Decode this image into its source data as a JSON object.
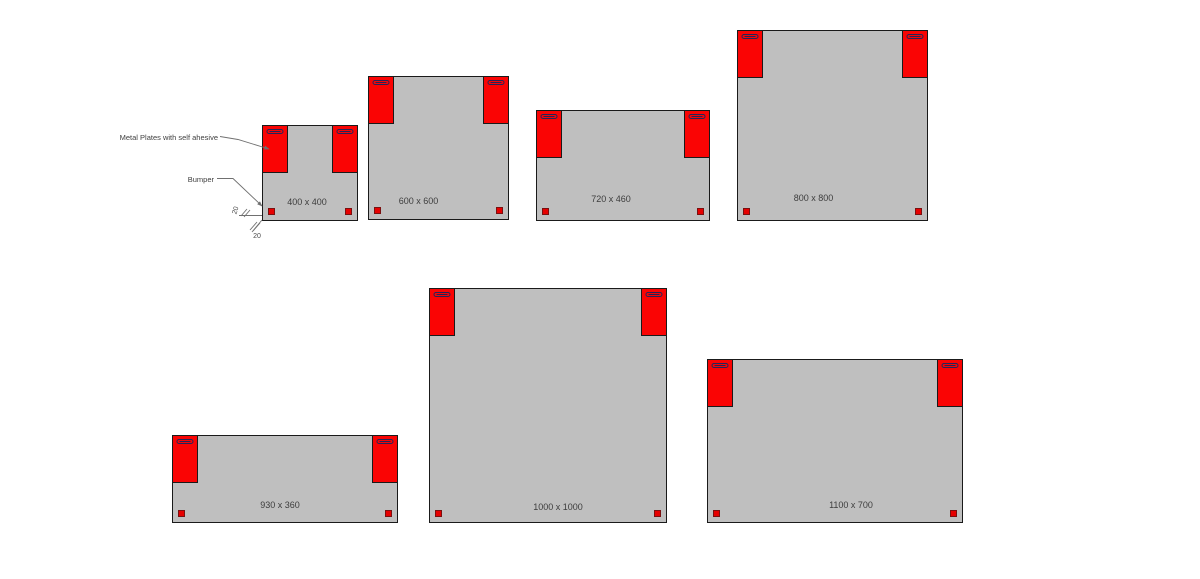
{
  "diagram": {
    "annotations": {
      "metal_plates": "Metal Plates with self ahesive",
      "bumper": "Bumper",
      "dim_vertical": "20",
      "dim_horizontal": "20"
    },
    "colors": {
      "background": "#ffffff",
      "panel_fill": "#bfbfbf",
      "panel_border": "#1a1a1a",
      "plate_fill": "#fa0404",
      "plate_border": "#1a1a1a",
      "slot_border": "#26265a",
      "bumper_fill": "#e60000",
      "bumper_border": "#7a1010",
      "label_text": "#3d3d3d",
      "leader_line": "#707070"
    },
    "panels": [
      {
        "label": "400 x 400",
        "x": 262,
        "y": 125,
        "w": 96,
        "h": 96,
        "label_dx": -3,
        "label_bottom": 13
      },
      {
        "label": "600 x 600",
        "x": 368,
        "y": 76,
        "w": 141,
        "h": 144,
        "label_dx": -20,
        "label_bottom": 13
      },
      {
        "label": "720 x 460",
        "x": 536,
        "y": 110,
        "w": 174,
        "h": 111,
        "label_dx": -12,
        "label_bottom": 16
      },
      {
        "label": "800 x 800",
        "x": 737,
        "y": 30,
        "w": 191,
        "h": 191,
        "label_dx": -19,
        "label_bottom": 17
      },
      {
        "label": "930 x 360",
        "x": 172,
        "y": 435,
        "w": 226,
        "h": 88,
        "label_dx": -5,
        "label_bottom": 12
      },
      {
        "label": "1000 x 1000",
        "x": 429,
        "y": 288,
        "w": 238,
        "h": 235,
        "label_dx": 10,
        "label_bottom": 10
      },
      {
        "label": "1100 x 700",
        "x": 707,
        "y": 359,
        "w": 256,
        "h": 164,
        "label_dx": 16,
        "label_bottom": 12
      }
    ],
    "plate": {
      "width": 26,
      "height": 48,
      "slot_width": 17,
      "slot_height": 5,
      "slot_top": 3
    },
    "bumper": {
      "size": 7,
      "inset": 5
    }
  }
}
